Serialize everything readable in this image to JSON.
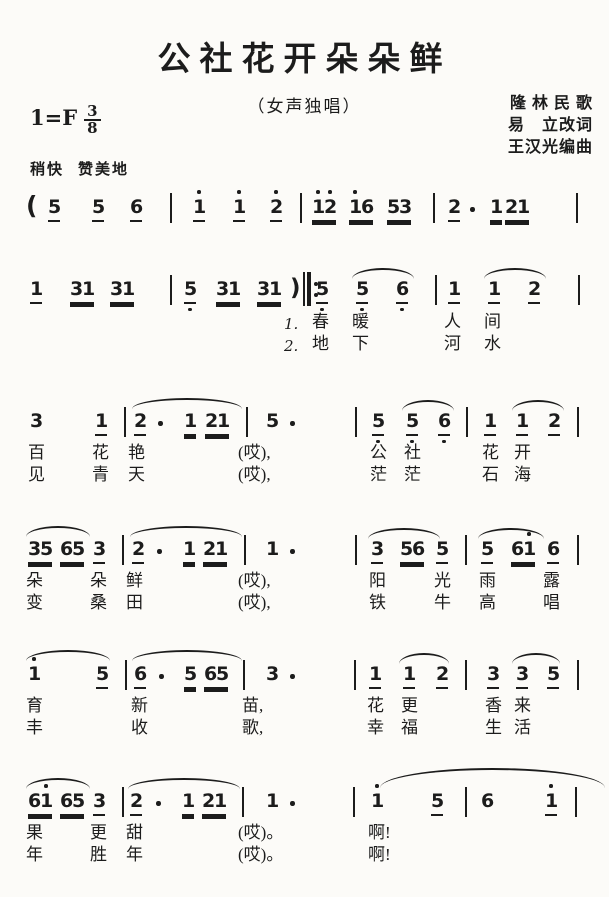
{
  "page": {
    "title": "公社花开朵朵鲜",
    "subtitle": "（女声独唱）",
    "credits": [
      "隆 林 民 歌",
      "易　立改词",
      "王汉光编曲"
    ],
    "key": "1=F",
    "meter_num": "3",
    "meter_den": "8",
    "tempo": "稍快",
    "expression": "赞美地"
  },
  "notation": {
    "ink": "#1c1c1c",
    "systems": [
      {
        "y": 196,
        "tokens": [
          {
            "k": "paren",
            "t": "(",
            "x": 26
          },
          {
            "t": "5",
            "x": 48,
            "ul": 1
          },
          {
            "t": "5",
            "x": 92,
            "ul": 1
          },
          {
            "t": "6",
            "x": 130,
            "ul": 1
          },
          {
            "k": "bar",
            "x": 170
          },
          {
            "t": "1",
            "x": 193,
            "ul": 1,
            "hi": "1"
          },
          {
            "t": "1",
            "x": 233,
            "ul": 1,
            "hi": "1"
          },
          {
            "t": "2",
            "x": 270,
            "ul": 1,
            "hi": "1"
          },
          {
            "k": "bar",
            "x": 300
          },
          {
            "t": "12",
            "x": 312,
            "ul": 2,
            "hi": "11"
          },
          {
            "t": "16",
            "x": 349,
            "ul": 2,
            "hi": "10"
          },
          {
            "t": "53",
            "x": 387,
            "ul": 2
          },
          {
            "k": "bar",
            "x": 433
          },
          {
            "t": "2",
            "x": 448,
            "ul": 1
          },
          {
            "k": "dot",
            "x": 470
          },
          {
            "t": "1",
            "x": 490,
            "ul": 2
          },
          {
            "t": "21",
            "x": 505,
            "ul": 2
          },
          {
            "k": "bar",
            "x": 576
          }
        ],
        "slurs": [],
        "lyrics": []
      },
      {
        "y": 278,
        "tokens": [
          {
            "t": "1",
            "x": 30,
            "ul": 1
          },
          {
            "t": "31",
            "x": 70,
            "ul": 2
          },
          {
            "t": "31",
            "x": 110,
            "ul": 2
          },
          {
            "k": "bar",
            "x": 170
          },
          {
            "t": "5",
            "x": 184,
            "ul": 1,
            "lo": "1"
          },
          {
            "t": "31",
            "x": 216,
            "ul": 2
          },
          {
            "t": "31",
            "x": 257,
            "ul": 2
          },
          {
            "k": "rep",
            "x": 290
          },
          {
            "t": "5",
            "x": 316,
            "ul": 1,
            "lo": "1"
          },
          {
            "t": "5",
            "x": 356,
            "ul": 1,
            "lo": "1"
          },
          {
            "t": "6",
            "x": 396,
            "ul": 1,
            "lo": "1"
          },
          {
            "k": "bar",
            "x": 435
          },
          {
            "t": "1",
            "x": 448,
            "ul": 1
          },
          {
            "t": "1",
            "x": 488,
            "ul": 1
          },
          {
            "t": "2",
            "x": 528,
            "ul": 1
          },
          {
            "k": "bar",
            "x": 578
          }
        ],
        "slurs": [
          {
            "x": 352,
            "y": 268,
            "w": 62
          },
          {
            "x": 484,
            "y": 268,
            "w": 62
          }
        ],
        "lyrics": [
          {
            "t": "1.",
            "x": 284,
            "y": 314,
            "c": "verse"
          },
          {
            "t": "春",
            "x": 312,
            "y": 312
          },
          {
            "t": "暖",
            "x": 352,
            "y": 312
          },
          {
            "t": "人",
            "x": 444,
            "y": 312
          },
          {
            "t": "间",
            "x": 484,
            "y": 312
          },
          {
            "t": "2.",
            "x": 284,
            "y": 336,
            "c": "verse"
          },
          {
            "t": "地",
            "x": 312,
            "y": 334
          },
          {
            "t": "下",
            "x": 352,
            "y": 334
          },
          {
            "t": "河",
            "x": 444,
            "y": 334
          },
          {
            "t": "水",
            "x": 484,
            "y": 334
          }
        ]
      },
      {
        "y": 410,
        "tokens": [
          {
            "t": "3",
            "x": 30
          },
          {
            "t": "1",
            "x": 95,
            "ul": 1
          },
          {
            "k": "bar",
            "x": 124
          },
          {
            "t": "2",
            "x": 134,
            "ul": 1
          },
          {
            "k": "dot",
            "x": 158
          },
          {
            "t": "1",
            "x": 184,
            "ul": 2
          },
          {
            "t": "21",
            "x": 205,
            "ul": 2
          },
          {
            "k": "bar",
            "x": 246
          },
          {
            "t": "5",
            "x": 266
          },
          {
            "k": "dot",
            "x": 290
          },
          {
            "k": "bar",
            "x": 355
          },
          {
            "t": "5",
            "x": 372,
            "ul": 1,
            "lo": "1"
          },
          {
            "t": "5",
            "x": 406,
            "ul": 1,
            "lo": "1"
          },
          {
            "t": "6",
            "x": 438,
            "ul": 1,
            "lo": "1"
          },
          {
            "k": "bar",
            "x": 466
          },
          {
            "t": "1",
            "x": 484,
            "ul": 1
          },
          {
            "t": "1",
            "x": 516,
            "ul": 1
          },
          {
            "t": "2",
            "x": 548,
            "ul": 1
          },
          {
            "k": "bar",
            "x": 577
          }
        ],
        "slurs": [
          {
            "x": 132,
            "y": 398,
            "w": 110
          },
          {
            "x": 402,
            "y": 400,
            "w": 52
          },
          {
            "x": 512,
            "y": 400,
            "w": 52
          }
        ],
        "lyrics": [
          {
            "t": "百",
            "x": 28,
            "y": 443
          },
          {
            "t": "花",
            "x": 92,
            "y": 443
          },
          {
            "t": "艳",
            "x": 128,
            "y": 443
          },
          {
            "t": "(哎),",
            "x": 238,
            "y": 443
          },
          {
            "t": "公",
            "x": 370,
            "y": 443
          },
          {
            "t": "社",
            "x": 404,
            "y": 443
          },
          {
            "t": "花",
            "x": 482,
            "y": 443
          },
          {
            "t": "开",
            "x": 514,
            "y": 443
          },
          {
            "t": "见",
            "x": 28,
            "y": 465
          },
          {
            "t": "青",
            "x": 92,
            "y": 465
          },
          {
            "t": "天",
            "x": 128,
            "y": 465
          },
          {
            "t": "(哎),",
            "x": 238,
            "y": 465
          },
          {
            "t": "茫",
            "x": 370,
            "y": 465
          },
          {
            "t": "茫",
            "x": 404,
            "y": 465
          },
          {
            "t": "石",
            "x": 482,
            "y": 465
          },
          {
            "t": "海",
            "x": 514,
            "y": 465
          }
        ]
      },
      {
        "y": 538,
        "tokens": [
          {
            "t": "35",
            "x": 28,
            "ul": 2
          },
          {
            "t": "65",
            "x": 60,
            "ul": 2
          },
          {
            "t": "3",
            "x": 93,
            "ul": 1
          },
          {
            "k": "bar",
            "x": 122
          },
          {
            "t": "2",
            "x": 132,
            "ul": 1
          },
          {
            "k": "dot",
            "x": 157
          },
          {
            "t": "1",
            "x": 183,
            "ul": 2
          },
          {
            "t": "21",
            "x": 203,
            "ul": 2
          },
          {
            "k": "bar",
            "x": 244
          },
          {
            "t": "1",
            "x": 266
          },
          {
            "k": "dot",
            "x": 290
          },
          {
            "k": "bar",
            "x": 355
          },
          {
            "t": "3",
            "x": 371,
            "ul": 1
          },
          {
            "t": "56",
            "x": 400,
            "ul": 2
          },
          {
            "t": "5",
            "x": 436,
            "ul": 1
          },
          {
            "k": "bar",
            "x": 465
          },
          {
            "t": "5",
            "x": 481,
            "ul": 1
          },
          {
            "t": "61",
            "x": 511,
            "ul": 2,
            "hi": "01"
          },
          {
            "t": "6",
            "x": 547,
            "ul": 1
          },
          {
            "k": "bar",
            "x": 577
          }
        ],
        "slurs": [
          {
            "x": 26,
            "y": 526,
            "w": 64
          },
          {
            "x": 130,
            "y": 526,
            "w": 112
          },
          {
            "x": 368,
            "y": 528,
            "w": 72
          },
          {
            "x": 478,
            "y": 528,
            "w": 66
          }
        ],
        "lyrics": [
          {
            "t": "朵",
            "x": 26,
            "y": 571
          },
          {
            "t": "朵",
            "x": 90,
            "y": 571
          },
          {
            "t": "鲜",
            "x": 126,
            "y": 571
          },
          {
            "t": "(哎),",
            "x": 238,
            "y": 571
          },
          {
            "t": "阳",
            "x": 369,
            "y": 571
          },
          {
            "t": "光",
            "x": 434,
            "y": 571
          },
          {
            "t": "雨",
            "x": 479,
            "y": 571
          },
          {
            "t": "露",
            "x": 543,
            "y": 571
          },
          {
            "t": "变",
            "x": 26,
            "y": 593
          },
          {
            "t": "桑",
            "x": 90,
            "y": 593
          },
          {
            "t": "田",
            "x": 126,
            "y": 593
          },
          {
            "t": "(哎),",
            "x": 238,
            "y": 593
          },
          {
            "t": "铁",
            "x": 369,
            "y": 593
          },
          {
            "t": "牛",
            "x": 434,
            "y": 593
          },
          {
            "t": "高",
            "x": 479,
            "y": 593
          },
          {
            "t": "唱",
            "x": 543,
            "y": 593
          }
        ]
      },
      {
        "y": 663,
        "tokens": [
          {
            "t": "1",
            "x": 28,
            "hi": "1"
          },
          {
            "t": "5",
            "x": 96,
            "ul": 1
          },
          {
            "k": "bar",
            "x": 125
          },
          {
            "t": "6",
            "x": 134,
            "ul": 1
          },
          {
            "k": "dot",
            "x": 159
          },
          {
            "t": "5",
            "x": 184,
            "ul": 2
          },
          {
            "t": "65",
            "x": 204,
            "ul": 2
          },
          {
            "k": "bar",
            "x": 243
          },
          {
            "t": "3",
            "x": 266
          },
          {
            "k": "dot",
            "x": 290
          },
          {
            "k": "bar",
            "x": 354
          },
          {
            "t": "1",
            "x": 369,
            "ul": 1
          },
          {
            "t": "1",
            "x": 403,
            "ul": 1
          },
          {
            "t": "2",
            "x": 436,
            "ul": 1
          },
          {
            "k": "bar",
            "x": 465
          },
          {
            "t": "3",
            "x": 487,
            "ul": 1
          },
          {
            "t": "3",
            "x": 516,
            "ul": 1
          },
          {
            "t": "5",
            "x": 547,
            "ul": 1
          },
          {
            "k": "bar",
            "x": 577
          }
        ],
        "slurs": [
          {
            "x": 26,
            "y": 650,
            "w": 84
          },
          {
            "x": 132,
            "y": 650,
            "w": 110
          },
          {
            "x": 399,
            "y": 653,
            "w": 50
          },
          {
            "x": 512,
            "y": 653,
            "w": 48
          }
        ],
        "lyrics": [
          {
            "t": "育",
            "x": 26,
            "y": 696
          },
          {
            "t": "新",
            "x": 131,
            "y": 696
          },
          {
            "t": "苗,",
            "x": 242,
            "y": 696
          },
          {
            "t": "花",
            "x": 367,
            "y": 696
          },
          {
            "t": "更",
            "x": 401,
            "y": 696
          },
          {
            "t": "香",
            "x": 485,
            "y": 696
          },
          {
            "t": "来",
            "x": 514,
            "y": 696
          },
          {
            "t": "丰",
            "x": 26,
            "y": 718
          },
          {
            "t": "收",
            "x": 131,
            "y": 718
          },
          {
            "t": "歌,",
            "x": 242,
            "y": 718
          },
          {
            "t": "幸",
            "x": 367,
            "y": 718
          },
          {
            "t": "福",
            "x": 401,
            "y": 718
          },
          {
            "t": "生",
            "x": 485,
            "y": 718
          },
          {
            "t": "活",
            "x": 514,
            "y": 718
          }
        ]
      },
      {
        "y": 790,
        "tokens": [
          {
            "t": "61",
            "x": 28,
            "ul": 2,
            "hi": "01"
          },
          {
            "t": "65",
            "x": 60,
            "ul": 2
          },
          {
            "t": "3",
            "x": 93,
            "ul": 1
          },
          {
            "k": "bar",
            "x": 122
          },
          {
            "t": "2",
            "x": 130,
            "ul": 1
          },
          {
            "k": "dot",
            "x": 156
          },
          {
            "t": "1",
            "x": 182,
            "ul": 2
          },
          {
            "t": "21",
            "x": 202,
            "ul": 2
          },
          {
            "k": "bar",
            "x": 242
          },
          {
            "t": "1",
            "x": 266
          },
          {
            "k": "dot",
            "x": 290
          },
          {
            "k": "bar",
            "x": 353
          },
          {
            "t": "1",
            "x": 371,
            "hi": "1"
          },
          {
            "t": "5",
            "x": 431,
            "ul": 1
          },
          {
            "k": "bar",
            "x": 465
          },
          {
            "t": "6",
            "x": 481
          },
          {
            "t": "1",
            "x": 545,
            "ul": 1,
            "hi": "1"
          },
          {
            "k": "bar",
            "x": 575
          }
        ],
        "slurs": [
          {
            "x": 26,
            "y": 778,
            "w": 64
          },
          {
            "x": 128,
            "y": 778,
            "w": 112
          },
          {
            "x": 380,
            "y": 768,
            "w": 225,
            "h": 18
          }
        ],
        "lyrics": [
          {
            "t": "果",
            "x": 26,
            "y": 823
          },
          {
            "t": "更",
            "x": 90,
            "y": 823
          },
          {
            "t": "甜",
            "x": 126,
            "y": 823
          },
          {
            "t": "(哎)。",
            "x": 238,
            "y": 823
          },
          {
            "t": "啊!",
            "x": 368,
            "y": 823
          },
          {
            "t": "年",
            "x": 26,
            "y": 845
          },
          {
            "t": "胜",
            "x": 90,
            "y": 845
          },
          {
            "t": "年",
            "x": 126,
            "y": 845
          },
          {
            "t": "(哎)。",
            "x": 238,
            "y": 845
          },
          {
            "t": "啊!",
            "x": 368,
            "y": 845
          }
        ]
      }
    ]
  }
}
